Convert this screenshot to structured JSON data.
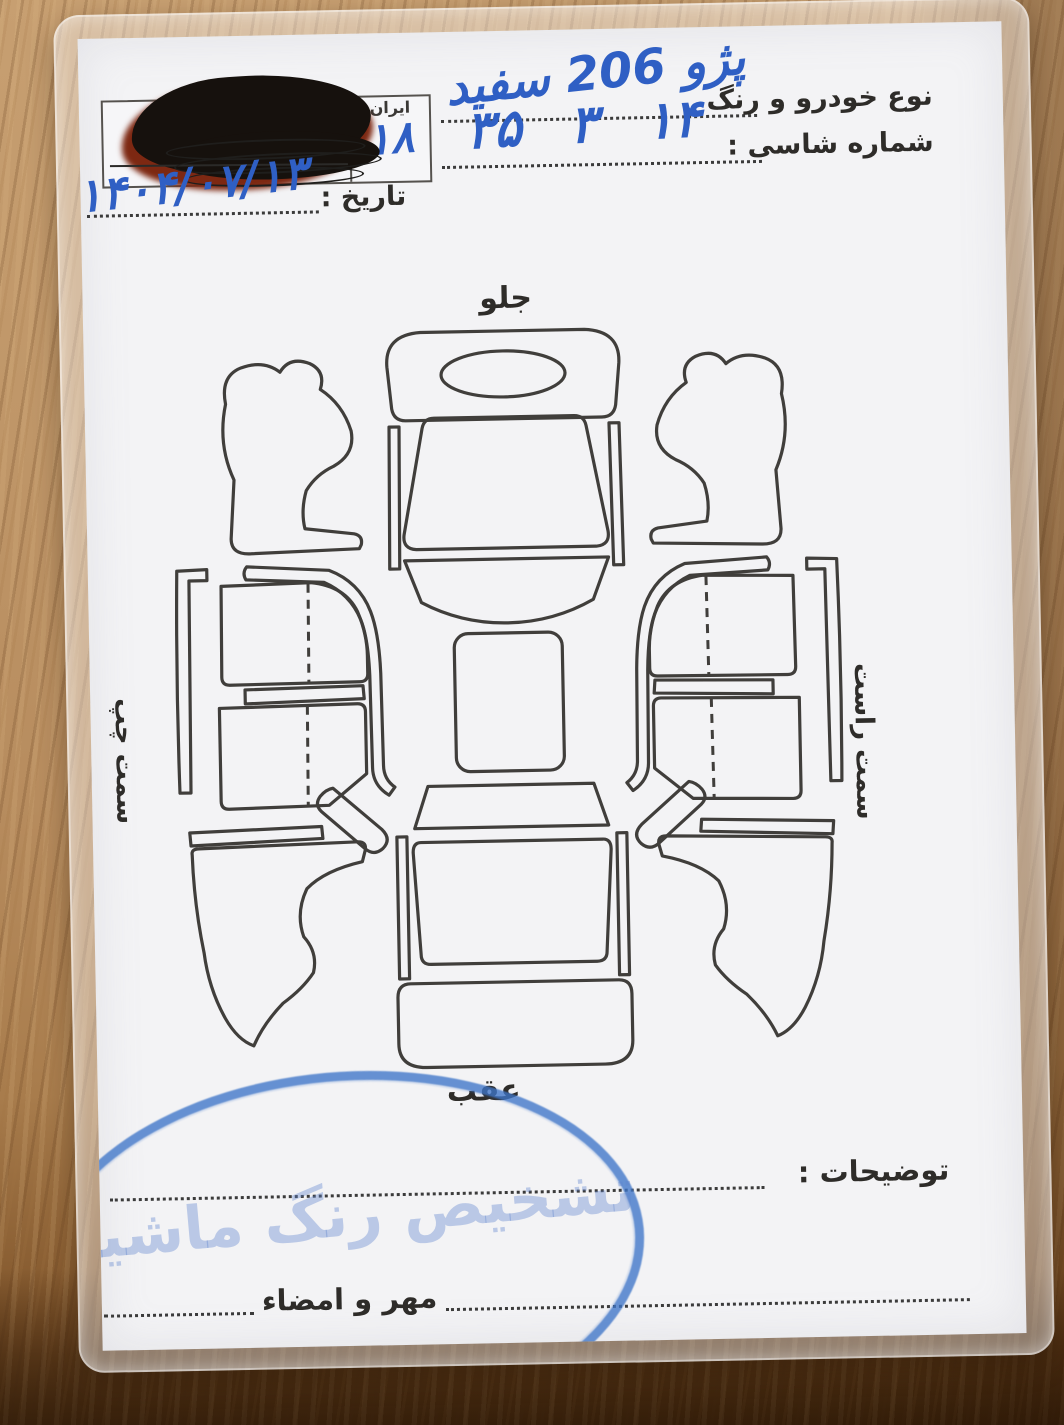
{
  "document": {
    "header": {
      "vehicle_type_label": "نوع خودرو و رنگ",
      "vehicle_type_value": "پژو 206 سفید",
      "chassis_label": "شماره شاسی :",
      "chassis_value": "۱۴ ۳ ۳۵",
      "date_label": "تاریخ :",
      "date_value": "۱۴۰۴/۰۷/۱۳",
      "plate": {
        "country_label": "ایران",
        "region_code": "۱۸"
      }
    },
    "diagram": {
      "front_label": "جلو",
      "rear_label": "عقب",
      "left_side_label": "سمت چپ",
      "right_side_label": "سمت راست"
    },
    "footer": {
      "comments_label": "توضیحات :",
      "stamp_signature_label": "مهر و امضاء",
      "stamp_text": "تشخیص رنگ ماشین"
    },
    "colors": {
      "handwriting_blue": "#2f5fc4",
      "stamp_blue": "#3e75c8",
      "print_ink": "#2e2c29",
      "card_paper": "#f3f3f5",
      "wood_light": "#c79f71",
      "wood_dark": "#56340f",
      "redaction_black": "#16110d",
      "redaction_red": "#7d2812"
    }
  }
}
